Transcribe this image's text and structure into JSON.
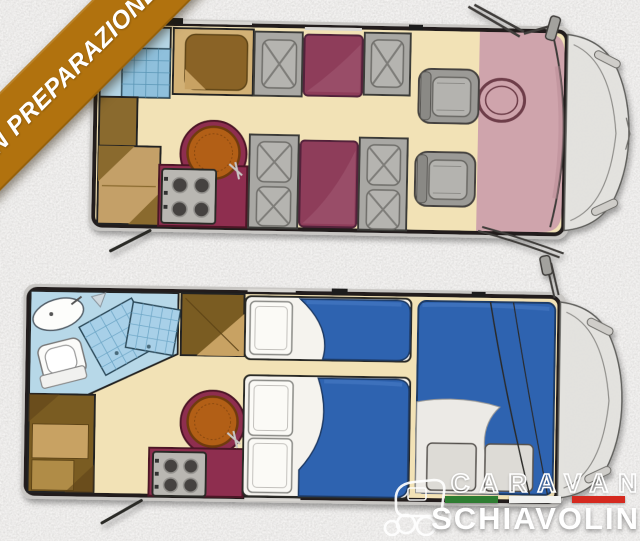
{
  "banner": {
    "label": "IN PREPARAZIONE"
  },
  "logo": {
    "brand_top": "CARAVAN",
    "brand_bottom": "SCHIAVOLIN",
    "flag": "italian-flag-divider"
  },
  "palette": {
    "banner_bg": "#b1720e",
    "banner_text": "#ffffff",
    "flag_green": "#2e7d32",
    "flag_white": "#f2f2f0",
    "flag_red": "#d5291f",
    "logo_text": "#ffffff",
    "background_gray": "#dad8d5",
    "floor_cream": "#f2e2b6",
    "wall_black": "#201e1b",
    "seat_maroon": "#8e3e5a",
    "counter_maroon": "#8e2d50",
    "bed_blue": "#2f63b0",
    "cab_pink": "#cfa4ac",
    "bath_blue": "#b7d8e8",
    "cabinet_brown": "#7a5c22",
    "cabinet_tan": "#c8a264",
    "table_brown": "#b25f17",
    "seat_gray": "#a9a8a4"
  },
  "floorplans": {
    "count": 2,
    "top": {
      "view": "day-configuration",
      "zones": [
        "bathroom-with-sink-and-shower",
        "wardrobe",
        "overhead-cabinet",
        "kitchen-with-hob-and-round-table",
        "dinette-facing-seats",
        "swivelled-cab-seats",
        "cab-with-steering-wheel"
      ]
    },
    "bottom": {
      "view": "night-configuration",
      "zones": [
        "bathroom-with-sink-toilet-and-shower",
        "wardrobe",
        "overhead-cabinet",
        "kitchen-with-hob-and-round-table",
        "single-bed",
        "double-bed",
        "drop-down-bed-over-cab"
      ]
    }
  }
}
